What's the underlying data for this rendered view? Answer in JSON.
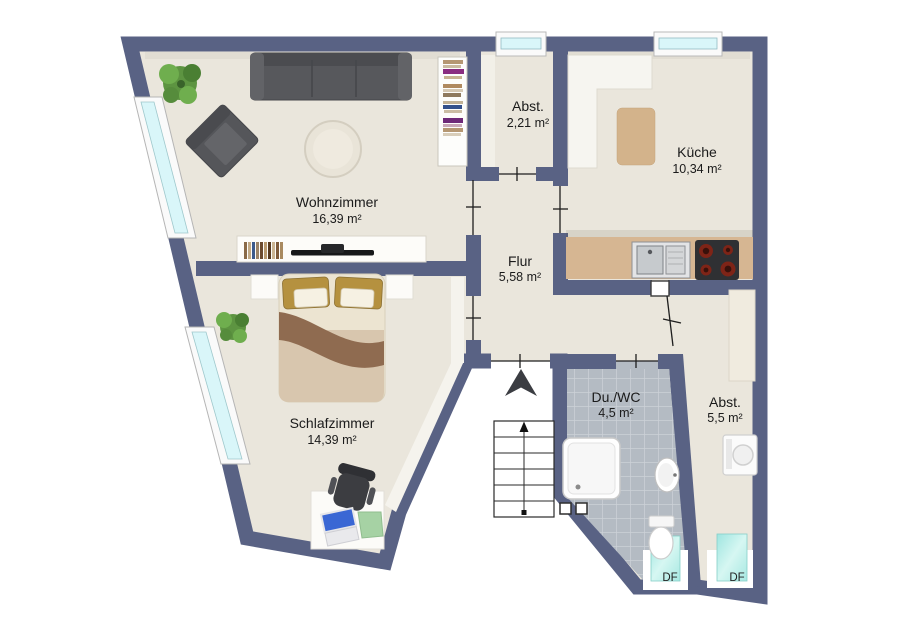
{
  "plan_title": "Apartment floor plan",
  "rooms": [
    {
      "name": "Wohnzimmer",
      "area": "16,39 m²"
    },
    {
      "name": "Abst.",
      "area": "2,21 m²"
    },
    {
      "name": "Küche",
      "area": "10,34 m²"
    },
    {
      "name": "Flur",
      "area": "5,58 m²"
    },
    {
      "name": "Schlafzimmer",
      "area": "14,39 m²"
    },
    {
      "name": "Du./WC",
      "area": "4,5 m²"
    },
    {
      "name": "Abst.",
      "area": "5,5 m²"
    }
  ],
  "roof_windows": [
    {
      "label": "DF"
    },
    {
      "label": "DF"
    }
  ],
  "icons": [
    "north-arrow-icon",
    "stairs-up-icon"
  ],
  "colors": {
    "wall": "#596284",
    "floor": "#eae6dc",
    "tile": "#b4bbc3",
    "kitchen_counter": "#d6b692",
    "kitchen_rug": "#d3b38b",
    "roof_window": "#aeebe7",
    "window_glass": "#d9f6f9",
    "sofa": "#57585c",
    "bed_blanket": "#8f6b50"
  }
}
